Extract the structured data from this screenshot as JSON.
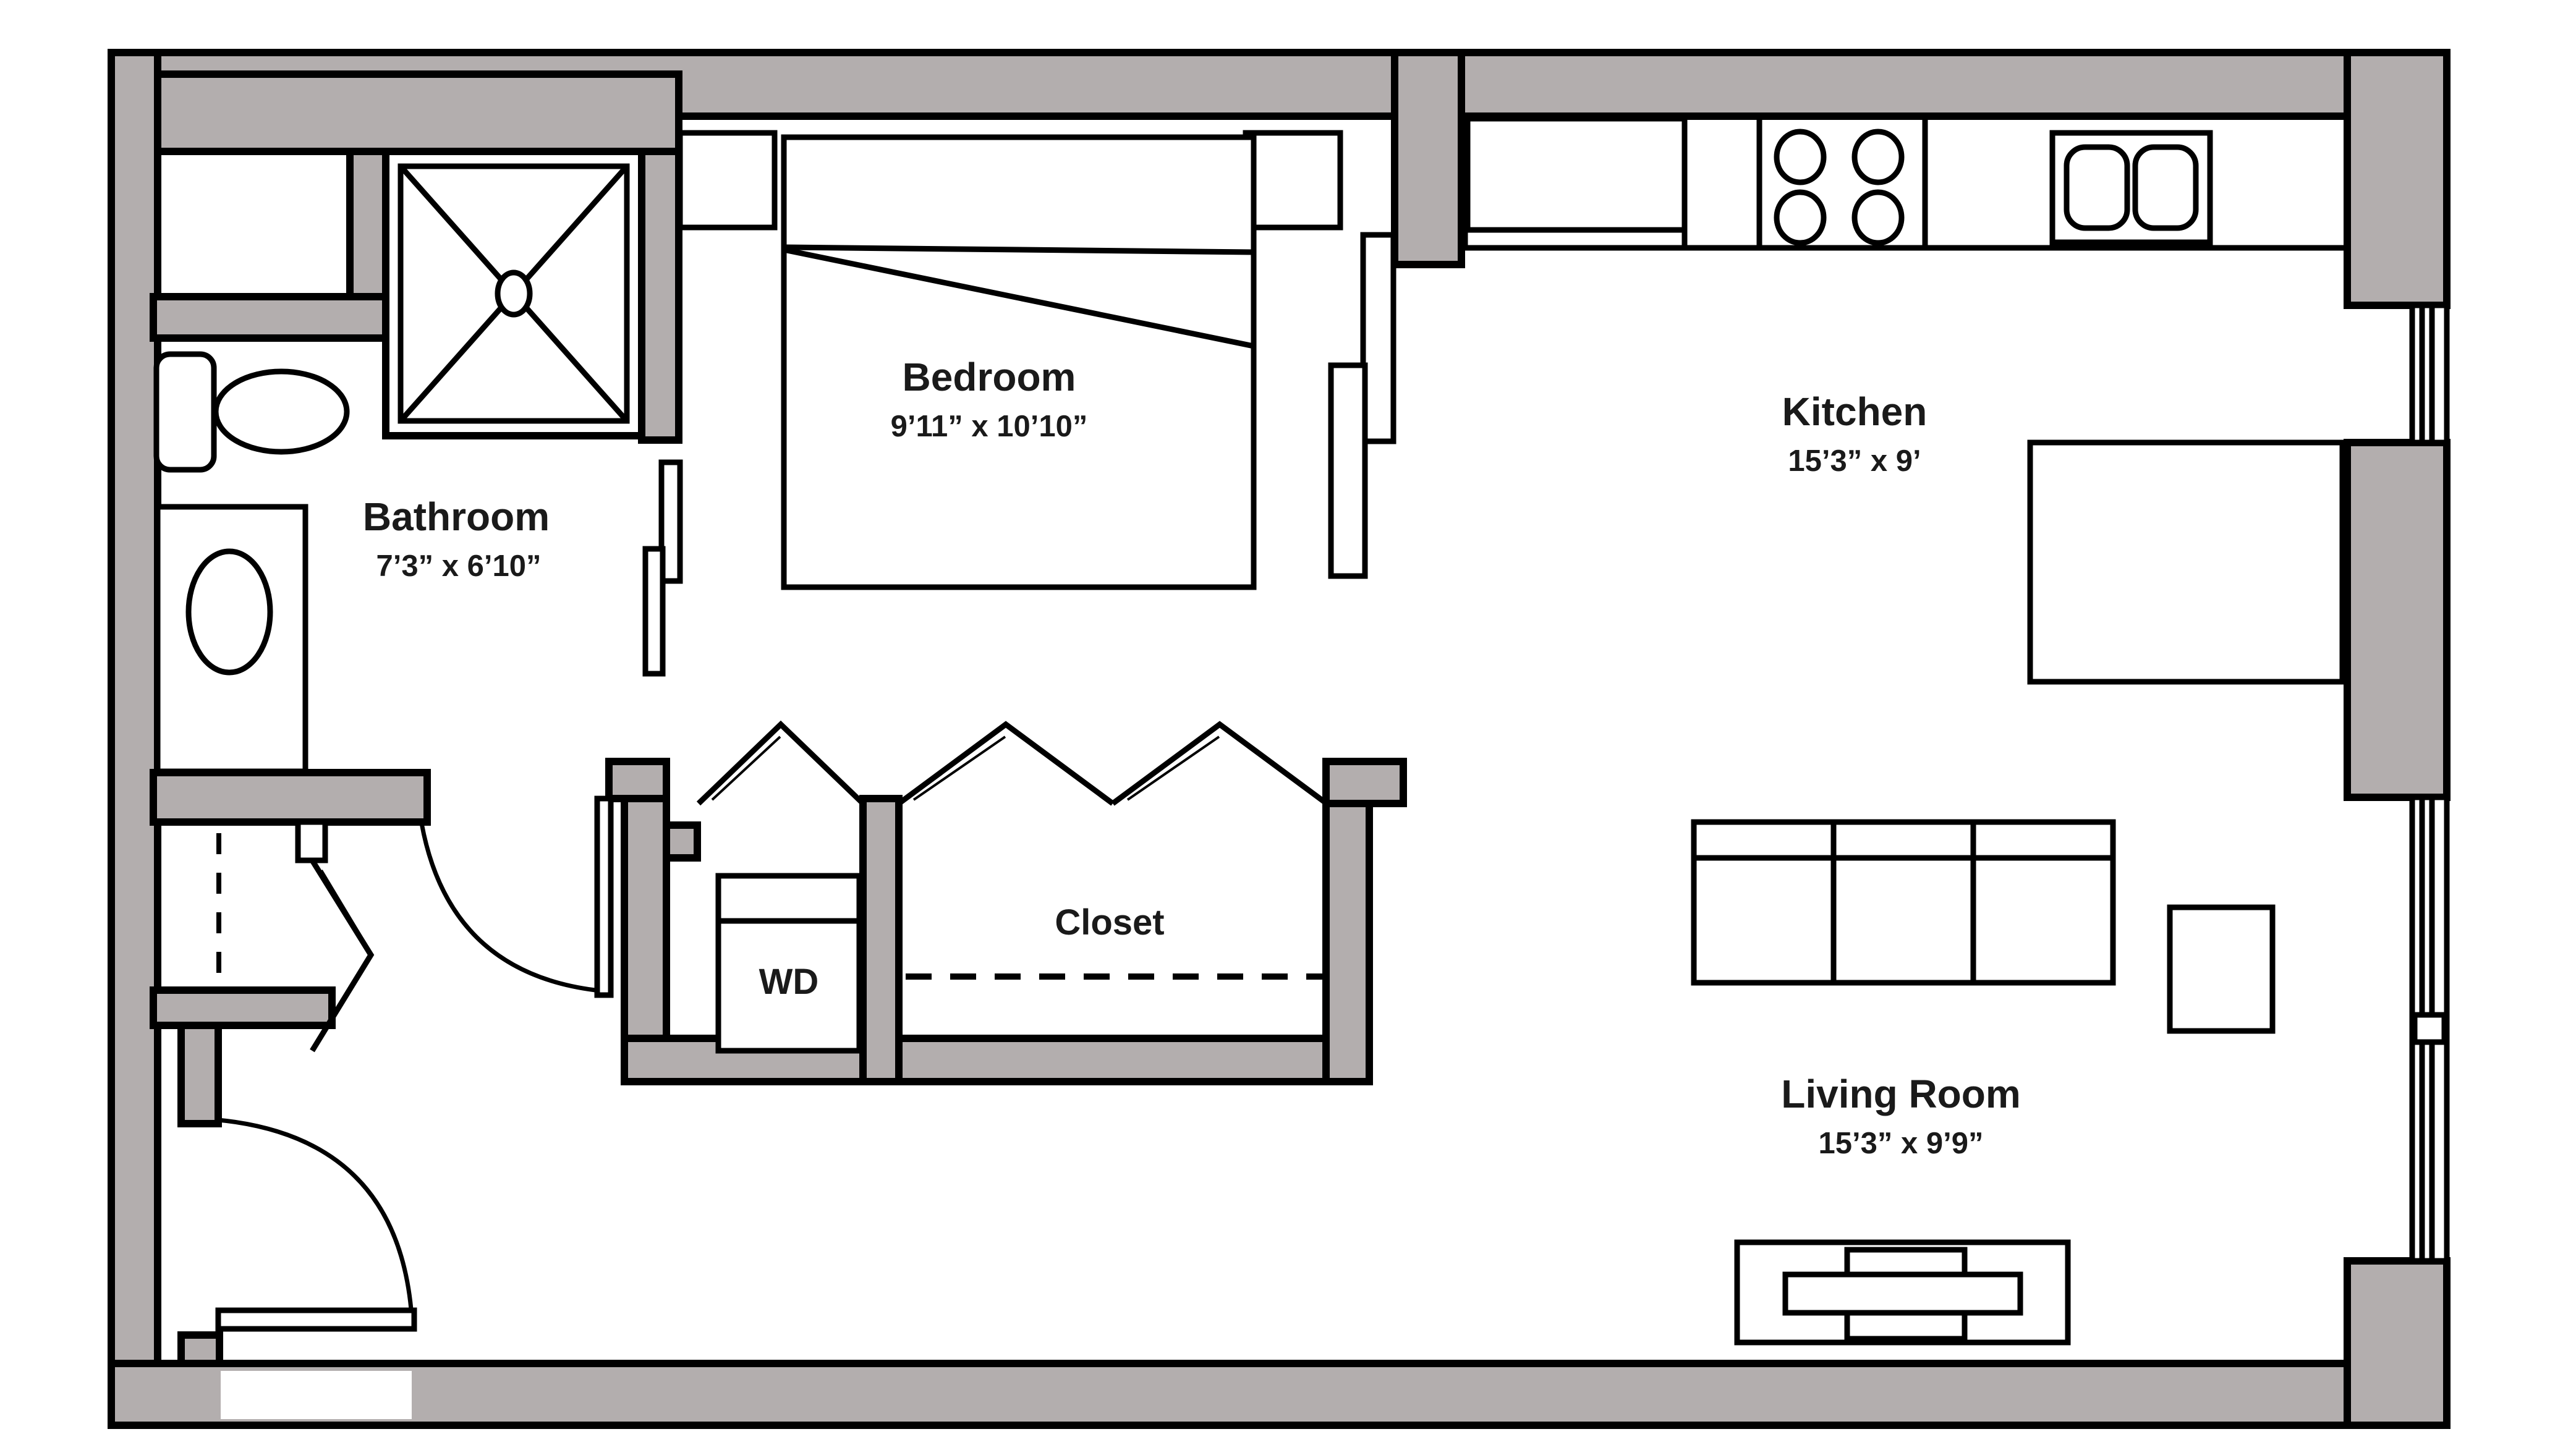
{
  "plan": {
    "type": "apartment-floor-plan",
    "wall_color": "#b3aeae",
    "line_color": "#000000",
    "background_color": "#ffffff",
    "rooms": {
      "bathroom": {
        "name": "Bathroom",
        "dimensions": "7’3” x 6’10”"
      },
      "bedroom": {
        "name": "Bedroom",
        "dimensions": "9’11” x 10’10”"
      },
      "kitchen": {
        "name": "Kitchen",
        "dimensions": "15’3” x 9’"
      },
      "living_room": {
        "name": "Living Room",
        "dimensions": "15’3” x 9’9”"
      },
      "closet": {
        "name": "Closet"
      },
      "laundry": {
        "name": "WD"
      }
    },
    "fixtures": [
      "shower-icon",
      "toilet-icon",
      "vanity-sink-icon",
      "shelf-niche-icon",
      "bed-icon",
      "nightstand-icon",
      "sliding-door-panels-icon",
      "refrigerator-icon",
      "counter-icon",
      "stove-burners-icon",
      "double-sink-icon",
      "kitchen-island-icon",
      "window-icon",
      "sofa-icon",
      "side-table-icon",
      "tv-console-icon",
      "washer-dryer-icon",
      "bifold-door-icon",
      "hinged-door-icon",
      "closet-rod-dashed-icon"
    ]
  }
}
